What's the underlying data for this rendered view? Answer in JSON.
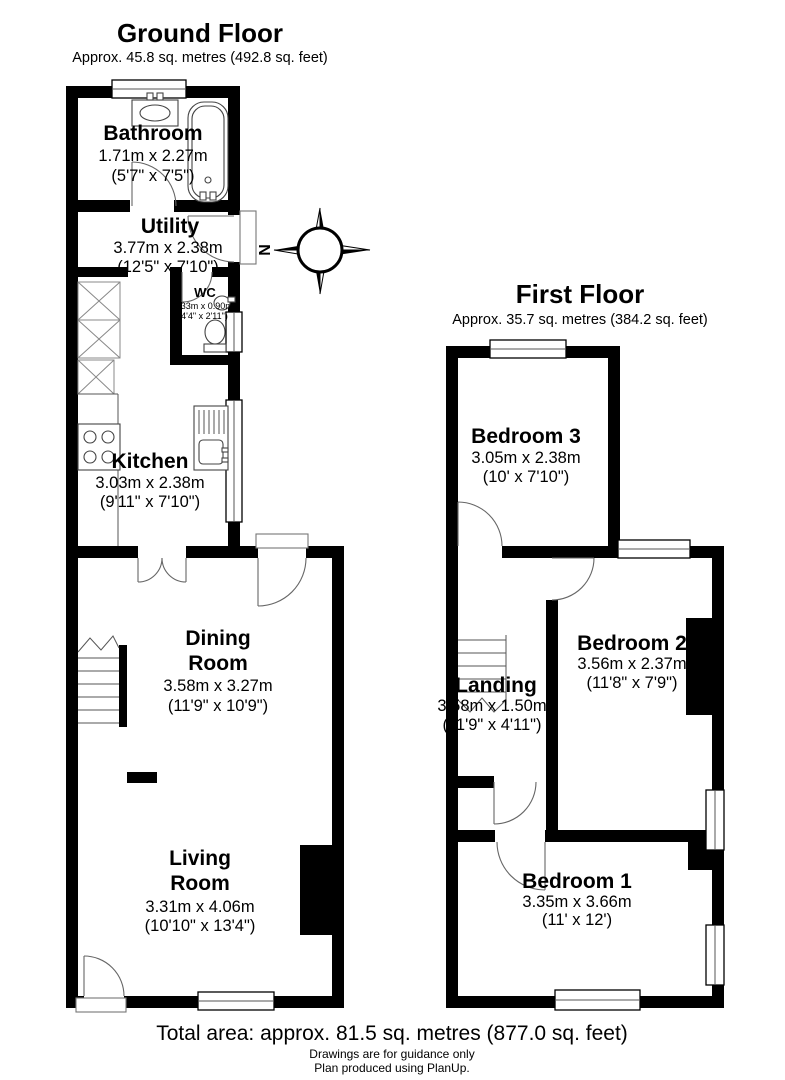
{
  "ground_floor": {
    "title": "Ground Floor",
    "subtitle": "Approx. 45.8 sq. metres (492.8 sq. feet)",
    "rooms": {
      "bathroom": {
        "name": "Bathroom",
        "metric": "1.71m x 2.27m",
        "imperial": "(5'7\" x 7'5\")"
      },
      "utility": {
        "name": "Utility",
        "metric": "3.77m x 2.38m",
        "imperial": "(12'5\" x 7'10\")"
      },
      "wc": {
        "name": "WC",
        "metric": "1.33m x 0.90m",
        "imperial": "(4'4\" x 2'11\")"
      },
      "kitchen": {
        "name": "Kitchen",
        "metric": "3.03m x 2.38m",
        "imperial": "(9'11\" x 7'10\")"
      },
      "dining": {
        "name_line1": "Dining",
        "name_line2": "Room",
        "metric": "3.58m x 3.27m",
        "imperial": "(11'9\" x 10'9\")"
      },
      "living": {
        "name_line1": "Living",
        "name_line2": "Room",
        "metric": "3.31m x 4.06m",
        "imperial": "(10'10\" x 13'4\")"
      }
    }
  },
  "first_floor": {
    "title": "First Floor",
    "subtitle": "Approx. 35.7 sq. metres (384.2 sq. feet)",
    "rooms": {
      "bedroom3": {
        "name": "Bedroom 3",
        "metric": "3.05m x 2.38m",
        "imperial": "(10' x 7'10\")"
      },
      "bedroom2": {
        "name": "Bedroom 2",
        "metric": "3.56m x 2.37m",
        "imperial": "(11'8\" x 7'9\")"
      },
      "landing": {
        "name": "Landing",
        "metric": "3.58m x 1.50m",
        "imperial": "(11'9\" x 4'11\")"
      },
      "bedroom1": {
        "name": "Bedroom 1",
        "metric": "3.35m x 3.66m",
        "imperial": "(11' x 12')"
      }
    }
  },
  "compass": {
    "north_label": "N"
  },
  "footer": {
    "total_area": "Total area: approx. 81.5 sq. metres (877.0 sq. feet)",
    "disclaimer": "Drawings are for guidance only",
    "credit": "Plan produced using PlanUp."
  },
  "colors": {
    "wall": "#000000",
    "background": "#ffffff"
  }
}
